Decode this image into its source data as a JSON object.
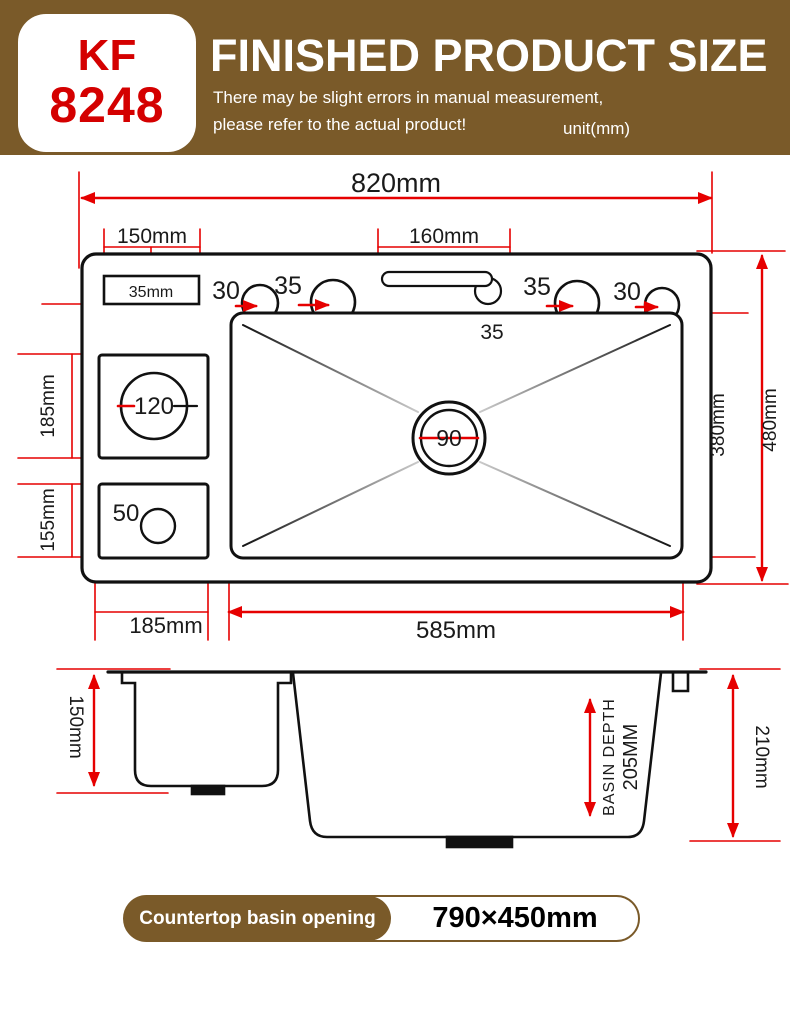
{
  "header": {
    "model_line1": "KF",
    "model_line2": "8248",
    "title": "FINISHED PRODUCT SIZE",
    "subtitle_line1": "There may be slight errors in manual measurement,",
    "subtitle_line2": "please refer to the actual product!",
    "unit": "unit(mm)"
  },
  "top_view": {
    "overall_width": "820mm",
    "left_deck_width": "150mm",
    "soap_tray_label": "35mm",
    "slot_width": "160mm",
    "slot_offset": "35",
    "hole_left_outer": "30",
    "hole_left_inner": "35",
    "hole_right_inner": "35",
    "hole_right_outer": "30",
    "accessory_hole": "120",
    "small_hole": "50",
    "drain_hole": "90",
    "left_upper_height": "185mm",
    "left_lower_height": "155mm",
    "left_bottom_width": "185mm",
    "basin_width": "585mm",
    "basin_height": "380mm",
    "overall_height": "480mm"
  },
  "side_view": {
    "left_basin_depth": "150mm",
    "basin_depth_label": "BASIN DEPTH",
    "basin_depth_value": "205MM",
    "overall_depth": "210mm"
  },
  "footer": {
    "label": "Countertop basin opening",
    "value": "790×450mm"
  },
  "colors": {
    "band_brown": "#7a5a29",
    "model_red": "#d40000",
    "dimension_red": "#e60000",
    "line_black": "#111111"
  }
}
